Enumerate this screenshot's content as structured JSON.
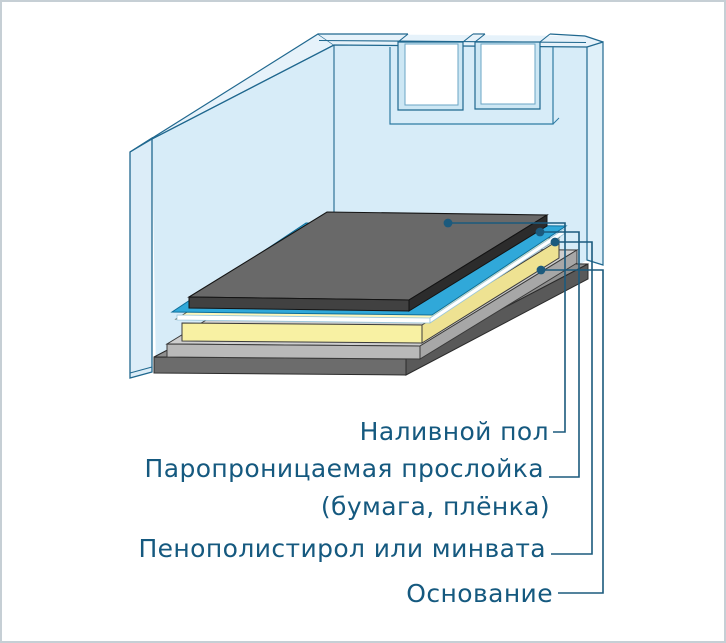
{
  "page": {
    "background": "#ffffff",
    "border_color": "#c6cfd5"
  },
  "diagram": {
    "type": "layered-floor-construction-cutaway",
    "language": "ru",
    "labels": {
      "topcoat": "Наливной пол",
      "film_line1": "Паропроницаемая прослойка",
      "film_line2": "(бумага, плёнка)",
      "insulation": "Пенополистирол или минвата",
      "base": "Основание"
    },
    "layers": [
      {
        "label": "Наливной пол",
        "color": "#696969"
      },
      {
        "label": "Паропроницаемая прослойка (бумага, плёнка)",
        "color": "#30a8d9"
      },
      {
        "label": "Пенополистирол или минвата",
        "color": "#f8f1a3"
      },
      {
        "label": "Основание",
        "color": "#6c6c6c"
      }
    ],
    "colors": {
      "wall_fill": "#d7ecf8",
      "wall_top_fill": "#e6f2fa",
      "wall_edge_fill": "#dcedf8",
      "wall_outline": "#20688f",
      "window_glass": "#ffffff",
      "window_reveal": "#cde7f4",
      "topcoat_top": "#696969",
      "topcoat_front": "#414141",
      "film_cyan": "#30a8d9",
      "film_paper": "#ffffff",
      "insulation_front": "#f8f1a3",
      "screed_top": "#cecece",
      "base_front": "#6c6c6c",
      "leader": "#1b5a7d",
      "label_text": "#15597f"
    }
  }
}
